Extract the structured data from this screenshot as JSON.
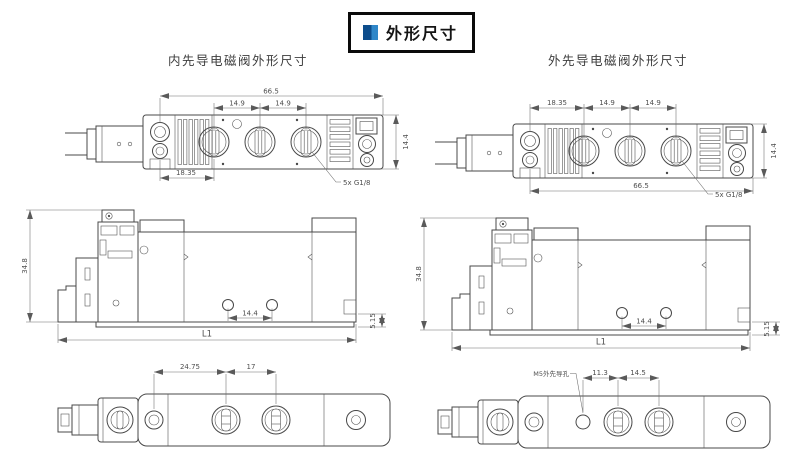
{
  "header": {
    "title": "外形尺寸"
  },
  "headings": {
    "left": "内先导电磁阀外形尺寸",
    "right": "外先导电磁阀外形尺寸"
  },
  "colors": {
    "accent_dark": "#0d4d8c",
    "accent_light": "#2f87c9",
    "line": "#484848"
  },
  "drawings": {
    "internal_top": {
      "overall": "66.5",
      "pitch_a": "14.9",
      "pitch_b": "14.9",
      "end_offset": "18.35",
      "height": "14.4",
      "port_note": "5x G1/8"
    },
    "external_top": {
      "end_offset": "18.35",
      "pitch_a": "14.9",
      "pitch_b": "14.9",
      "overall": "66.5",
      "height": "14.4",
      "port_note": "5x G1/8"
    },
    "internal_side": {
      "height": "34.8",
      "length": "L1",
      "hole_pitch": "14.4",
      "port_offset": "5.15"
    },
    "external_side": {
      "height": "34.8",
      "length": "L1",
      "hole_pitch": "14.4",
      "port_offset": "5.15"
    },
    "internal_bottom": {
      "port_offset": "24.75",
      "port_pitch": "17"
    },
    "external_bottom": {
      "pilot_note": "M5外先导孔",
      "pilot_to_port": "11.3",
      "port_pitch": "14.5"
    }
  }
}
